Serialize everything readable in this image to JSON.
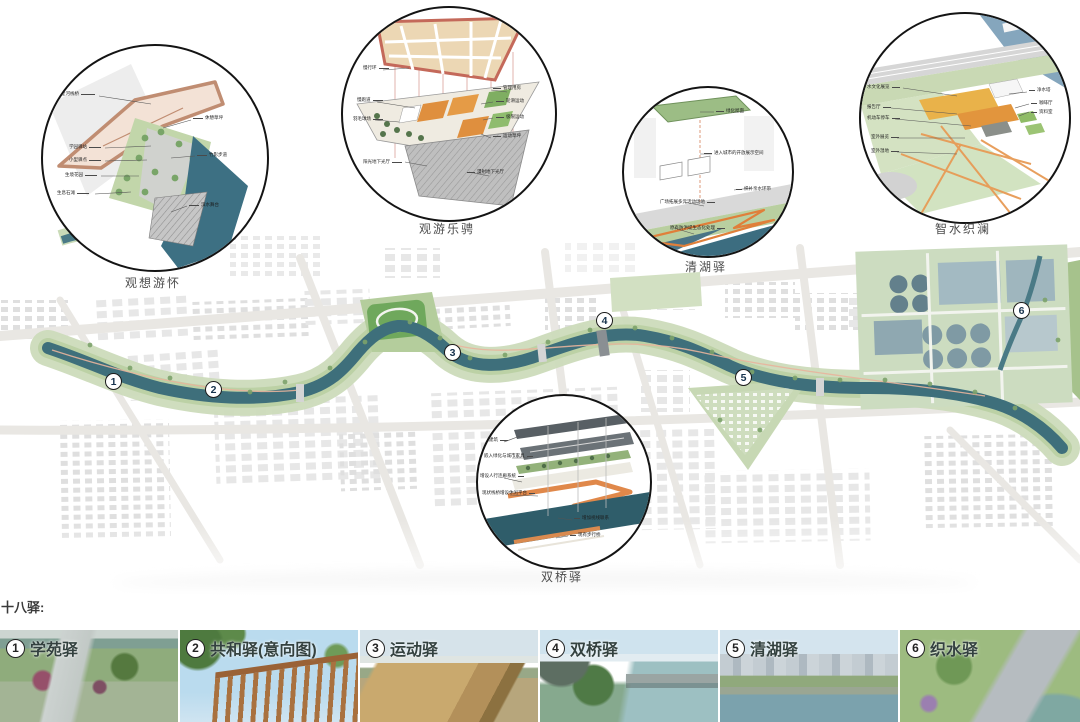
{
  "heading": "十八驿:",
  "detail_circles": [
    {
      "caption": "观想游怀",
      "callouts": [
        "星河栈桥",
        "学园驿站",
        "小型驿点",
        "生境花园",
        "生息石滩",
        "休憩草坪",
        "竹影步道",
        "滨水舞台"
      ]
    },
    {
      "caption": "观游乐骋",
      "callouts": [
        "慢行环",
        "慢跑道",
        "羽毛球场",
        "管理用房",
        "轮滑运动",
        "极限运动",
        "运动草坪",
        "阳光地下光厅",
        "漫射地下光厅"
      ]
    },
    {
      "caption": "清湖驿",
      "callouts": [
        "绿化屋面",
        "进入城市的开放展示空间",
        "织补亲水环带",
        "广场拓展多元活动场地",
        "原有防洪堤生态化处理"
      ]
    },
    {
      "caption": "智水织澜",
      "callouts": [
        "水文化展览",
        "报告厅",
        "机动车停车",
        "室外展览",
        "室外湿地",
        "净水塔",
        "咖啡厅",
        "资料室"
      ]
    },
    {
      "caption": "双桥驿",
      "callouts": [
        "新建建筑",
        "嵌入绿化与城市家具",
        "增设人行连廊系统",
        "现状栈桥增设休闲平台",
        "增加视线联系",
        "现有步行桥"
      ]
    }
  ],
  "map": {
    "markers": [
      "1",
      "2",
      "3",
      "4",
      "5",
      "6"
    ]
  },
  "stations": [
    {
      "num": "1",
      "name": "学苑驿"
    },
    {
      "num": "2",
      "name": "共和驿(意向图)"
    },
    {
      "num": "3",
      "name": "运动驿"
    },
    {
      "num": "4",
      "name": "双桥驿"
    },
    {
      "num": "5",
      "name": "清湖驿"
    },
    {
      "num": "6",
      "name": "织水驿"
    }
  ],
  "colors": {
    "river": "#3e6f7b",
    "corridor_green": "#c3d5ad",
    "accent_orange": "#e08a45",
    "marker_border": "#1b1b1b"
  }
}
